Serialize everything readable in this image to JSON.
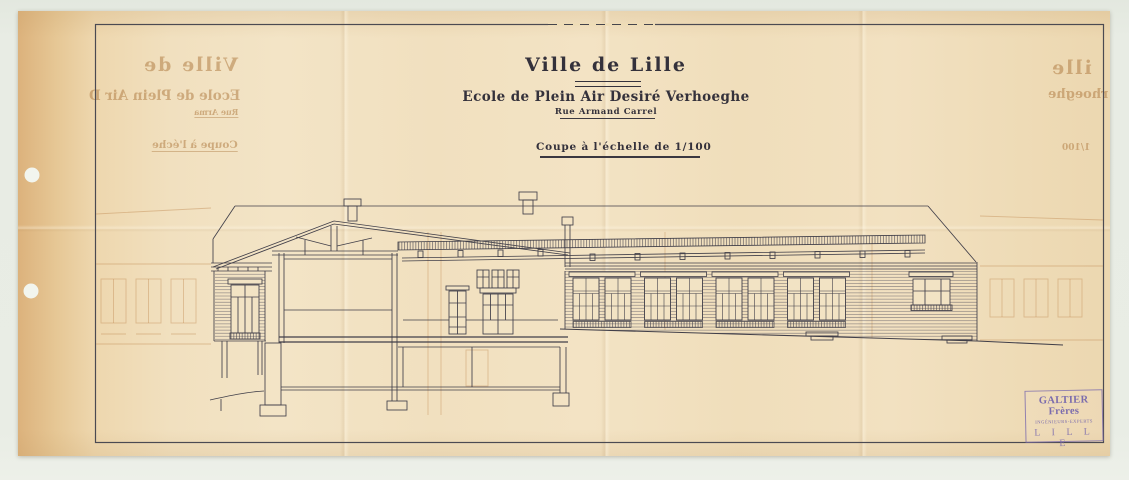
{
  "header": {
    "city": "Ville de Lille",
    "school": "Ecole de Plein Air Desiré Verhoeghe",
    "street": "Rue Armand Carrel",
    "caption": "Coupe à l'échelle de 1/100"
  },
  "stamp": {
    "name": "GALTIER Frères",
    "role": "INGÉNIEURS-EXPERTS",
    "city": "L I L L E",
    "ink_color": "#7b6cad"
  },
  "bleedthrough": {
    "left_title": "Ville de",
    "left_subtitle": "Ecole de Plein Air D",
    "left_street": "Rue Arma",
    "left_caption": "Coupe à l'éche",
    "right_title": "ille",
    "right_subtitle": "iré Verhoeghe",
    "right_scale": "1/100"
  },
  "colors": {
    "paper": "#f1e0bf",
    "ink": "#413f49",
    "ghost": "#c08c55",
    "scanner_bed": "#e8ece4"
  }
}
